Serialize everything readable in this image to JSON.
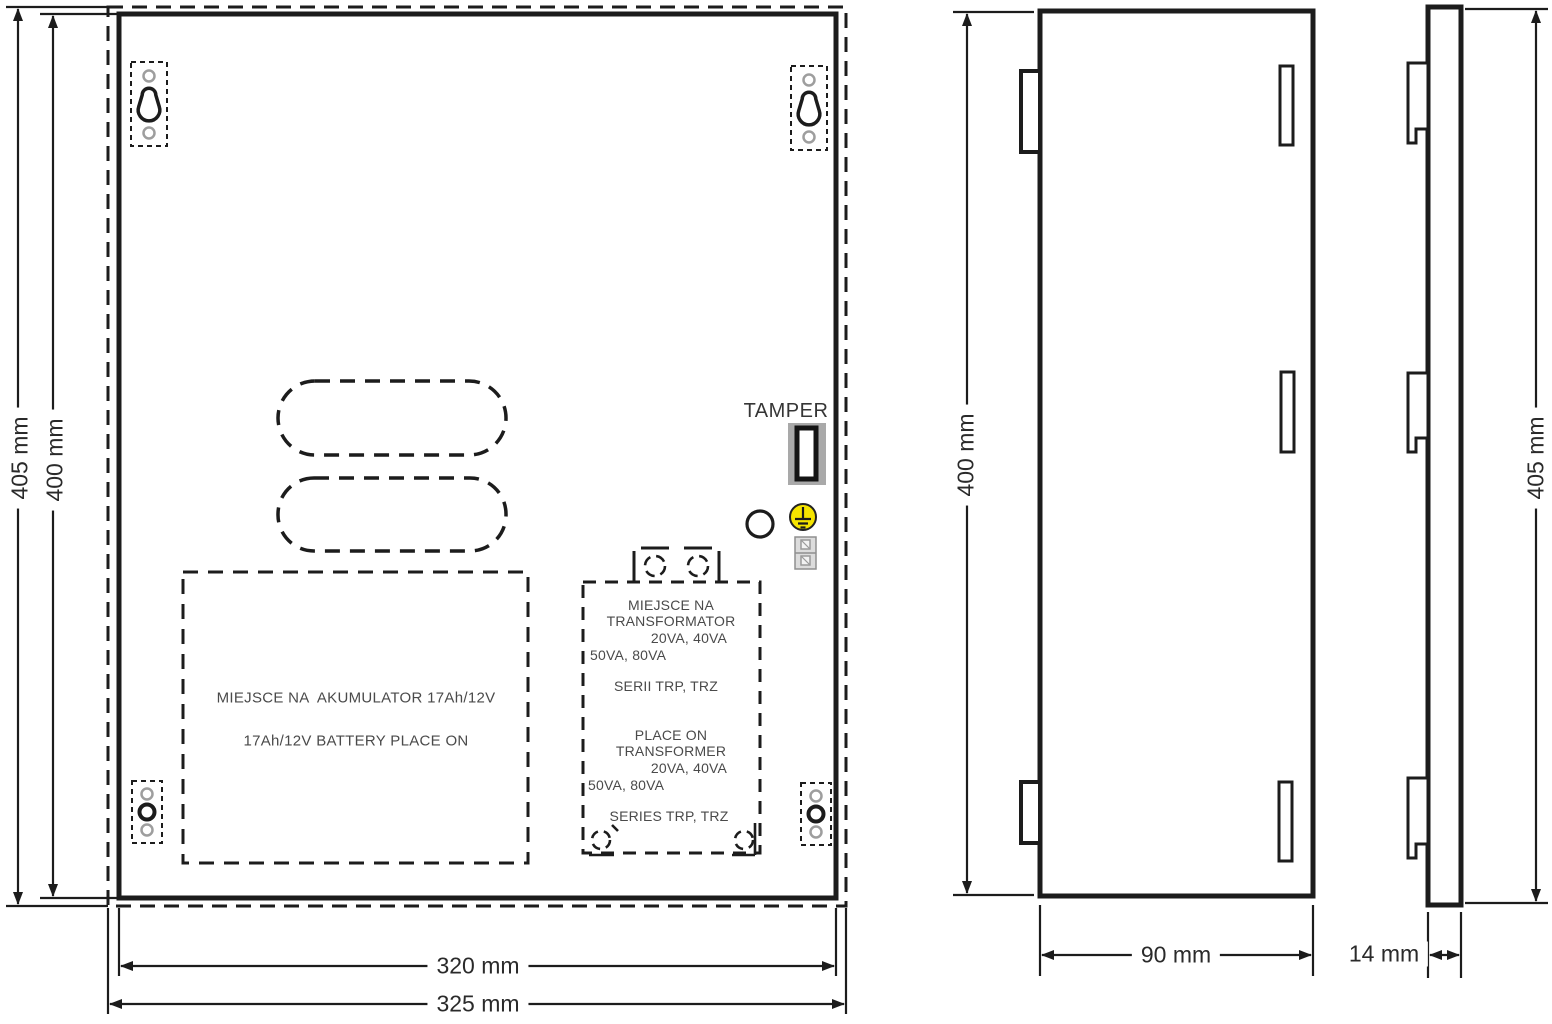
{
  "front_view": {
    "tamper_label": "TAMPER",
    "battery_area_line1": "MIEJSCE NA  AKUMULATOR 17Ah/12V",
    "battery_area_line2": "17Ah/12V BATTERY PLACE ON",
    "transformer_area": {
      "pl_line1": "MIEJSCE NA",
      "pl_line2": "TRANSFORMATOR",
      "pl_line3": "20VA, 40VA",
      "pl_line4": "50VA, 80VA",
      "pl_series": "SERII TRP, TRZ",
      "en_line1": "PLACE ON",
      "en_line2": "TRANSFORMER",
      "en_line3": "20VA, 40VA",
      "en_line4": "50VA, 80VA",
      "en_series": "SERIES TRP, TRZ"
    },
    "dim_height_outer": "405 mm",
    "dim_height_inner": "400 mm",
    "dim_width_inner": "320 mm",
    "dim_width_outer": "325 mm"
  },
  "side_view": {
    "dim_height": "400 mm",
    "dim_depth": "90 mm"
  },
  "profile_view": {
    "dim_height": "405 mm",
    "dim_depth": "14 mm"
  },
  "colors": {
    "line": "#1c1c1c",
    "tamper_switch_bg": "#a9a9a9",
    "ground_symbol_yellow": "#f5e400",
    "mount_hole_gray": "#9e9e9e"
  }
}
